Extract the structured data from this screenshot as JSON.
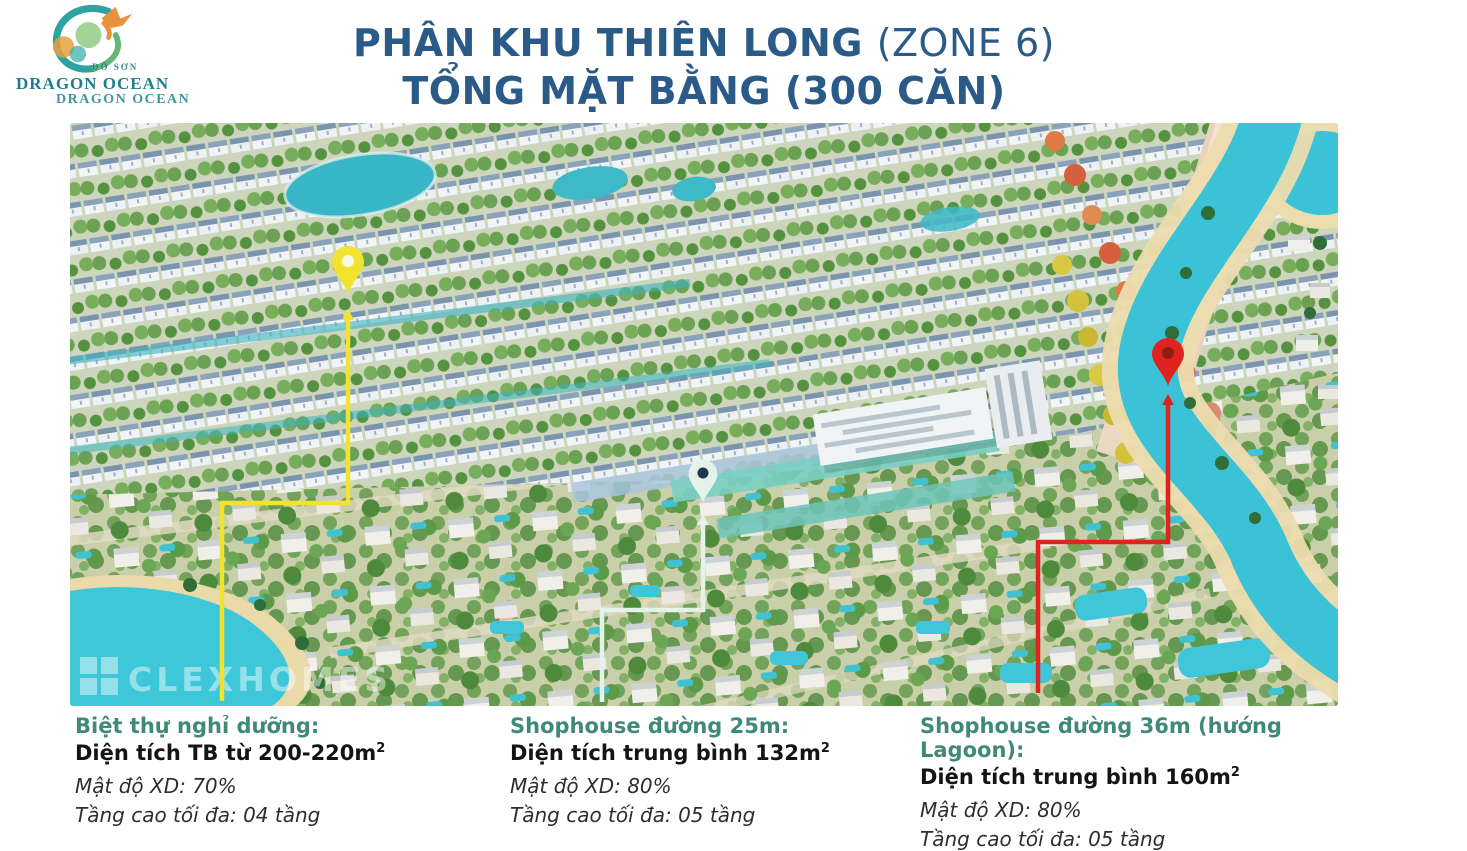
{
  "logo": {
    "region": "ĐỒ SƠN",
    "brand": "DRAGON OCEAN",
    "brand_echo": "DRAGON OCEAN",
    "brand_color": "#1f7e8e"
  },
  "title": {
    "line1_strong": "PHÂN KHU THIÊN LONG",
    "line1_normal": "(ZONE 6)",
    "line2": "TỔNG MẶT BẰNG (300 CĂN)",
    "color": "#2a5b88"
  },
  "masterplan": {
    "watermark": "CLEXHOMES",
    "pins": [
      {
        "name": "villa-pin",
        "color": "#f2e32e",
        "hole_color": "#fbf9e6"
      },
      {
        "name": "shophouse-25m-pin",
        "color": "#e4f2ea",
        "hole_color": "#22384a"
      },
      {
        "name": "shophouse-36m-pin",
        "color": "#e0231f",
        "hole_color": "#8c1e12"
      }
    ]
  },
  "legend": {
    "heading_color": "#3f8a76",
    "items": [
      {
        "heading": "Biệt thự nghỉ dưỡng:",
        "area": "Diện tích TB từ 200-220m",
        "area_sup": "2",
        "density": "Mật độ XD: 70%",
        "floors": "Tầng cao tối đa: 04 tầng"
      },
      {
        "heading": "Shophouse đường 25m:",
        "area": "Diện tích trung bình 132m",
        "area_sup": "2",
        "density": "Mật độ XD: 80%",
        "floors": "Tầng cao tối đa: 05 tầng"
      },
      {
        "heading": "Shophouse đường 36m (hướng Lagoon):",
        "area": "Diện tích trung bình 160m",
        "area_sup": "2",
        "density": "Mật độ XD: 80%",
        "floors": "Tầng cao tối đa: 05 tầng"
      }
    ]
  }
}
